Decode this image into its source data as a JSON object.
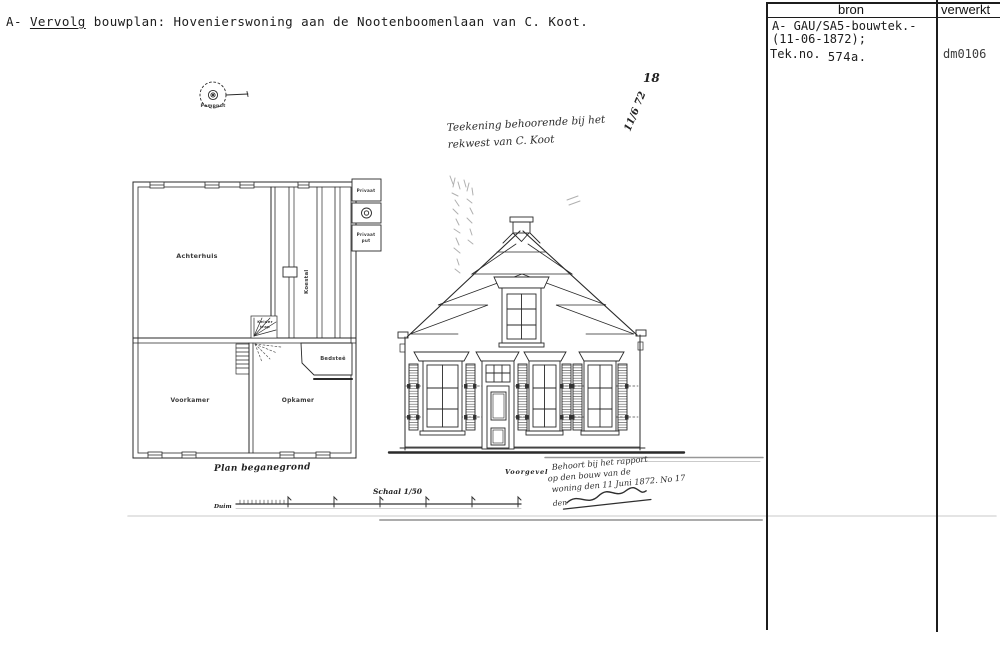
{
  "header": {
    "prefix": "A-",
    "underlined": "Vervolg",
    "rest": "bouwplan: Hovenierswoning aan de Nootenboomenlaan van C. Koot."
  },
  "catalog": {
    "bron_header": "bron",
    "verwerkt_header": "verwerkt",
    "source_line1": "A- GAU/SA5-bouwtek.-",
    "source_line2": "(11-06-1872);",
    "source_line3_label": "Tek.no.",
    "source_line3_value": "574a.",
    "verwerkt_value": "dm0106"
  },
  "drawing": {
    "pompput_label": "Pompput",
    "plan": {
      "achterhuis": "Achterhuis",
      "koestal": "Koestal",
      "voorkamer": "Voorkamer",
      "opkamer": "Opkamer",
      "bedstee": "Bedsteê",
      "stair_line1": "Kelder",
      "stair_line2": "trap",
      "privaat": "Privaat",
      "privaat_put_line1": "Privaat",
      "privaat_put_line2": "put",
      "caption": "Plan beganegrond"
    },
    "elevation": {
      "caption": "Voorgevel"
    },
    "scale": {
      "label": "Schaal 1/50",
      "unit": "Duim"
    },
    "notes": {
      "dedication_line1": "Teekening behoorende bij het",
      "dedication_line2": "rekwest van C. Koot",
      "date_top": "18",
      "date_slant": "11/6 72",
      "approval_line1": "Behoort bij het rapport",
      "approval_line2": "op den bouw van de",
      "approval_line3": "woning den 11 Juni 1872. No 17",
      "approval_line4": "den"
    }
  },
  "colors": {
    "ink": "#1f1f1f",
    "line": "#2a2a2a",
    "faint": "#9a9a9a",
    "paper": "#ffffff"
  }
}
